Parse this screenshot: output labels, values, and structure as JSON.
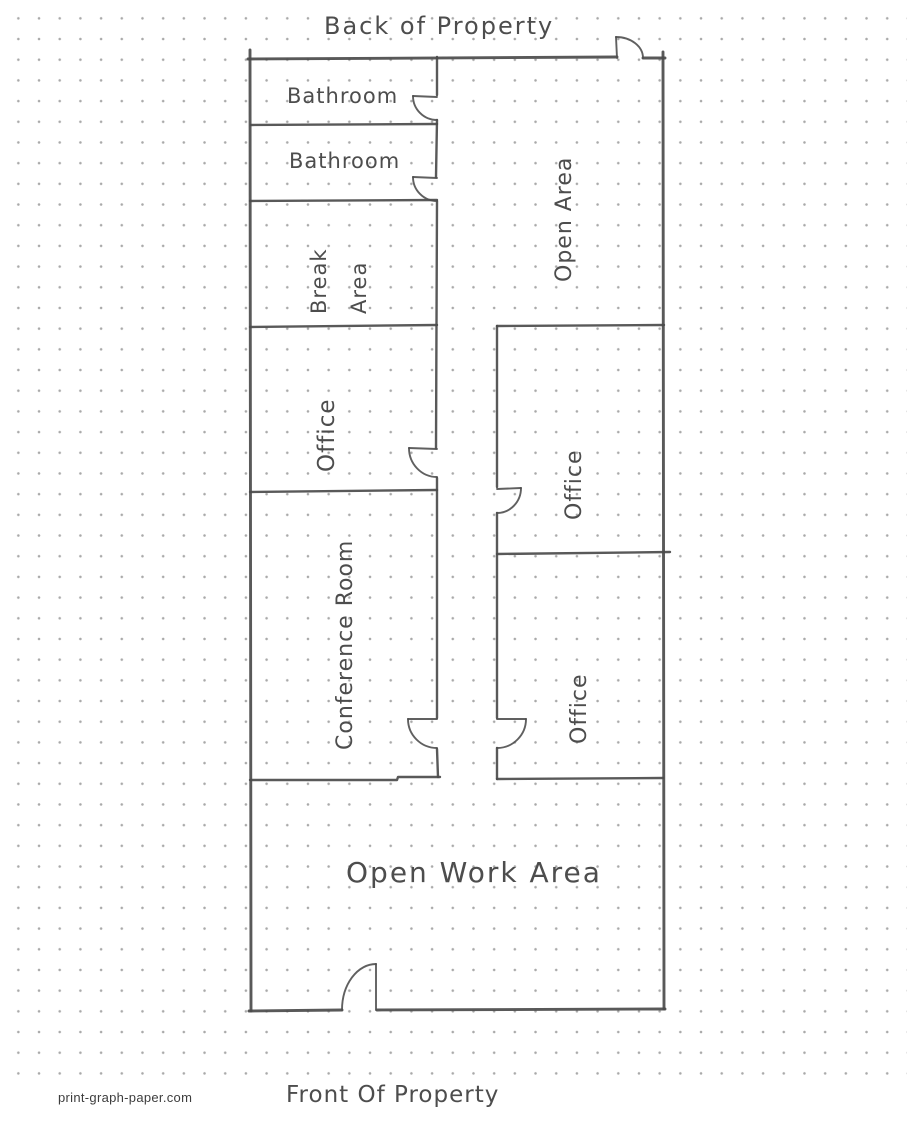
{
  "page": {
    "back_label": "Back of Property",
    "front_label": "Front Of Property",
    "watermark": "print-graph-paper.com"
  },
  "rooms": {
    "bathroom_top": "Bathroom",
    "bathroom_second": "Bathroom",
    "break_area_line1": "Break",
    "break_area_line2": "Area",
    "open_area": "Open Area",
    "office_left": "Office",
    "office_right_upper": "Office",
    "conference_room": "Conference Room",
    "office_right_lower": "Office",
    "open_work_area": "Open Work Area"
  },
  "colors": {
    "pencil": "#4b4b4b",
    "handwriting": "#4d4d4d",
    "dot_grid": "#9a9a9a",
    "paper": "#ffffff"
  }
}
